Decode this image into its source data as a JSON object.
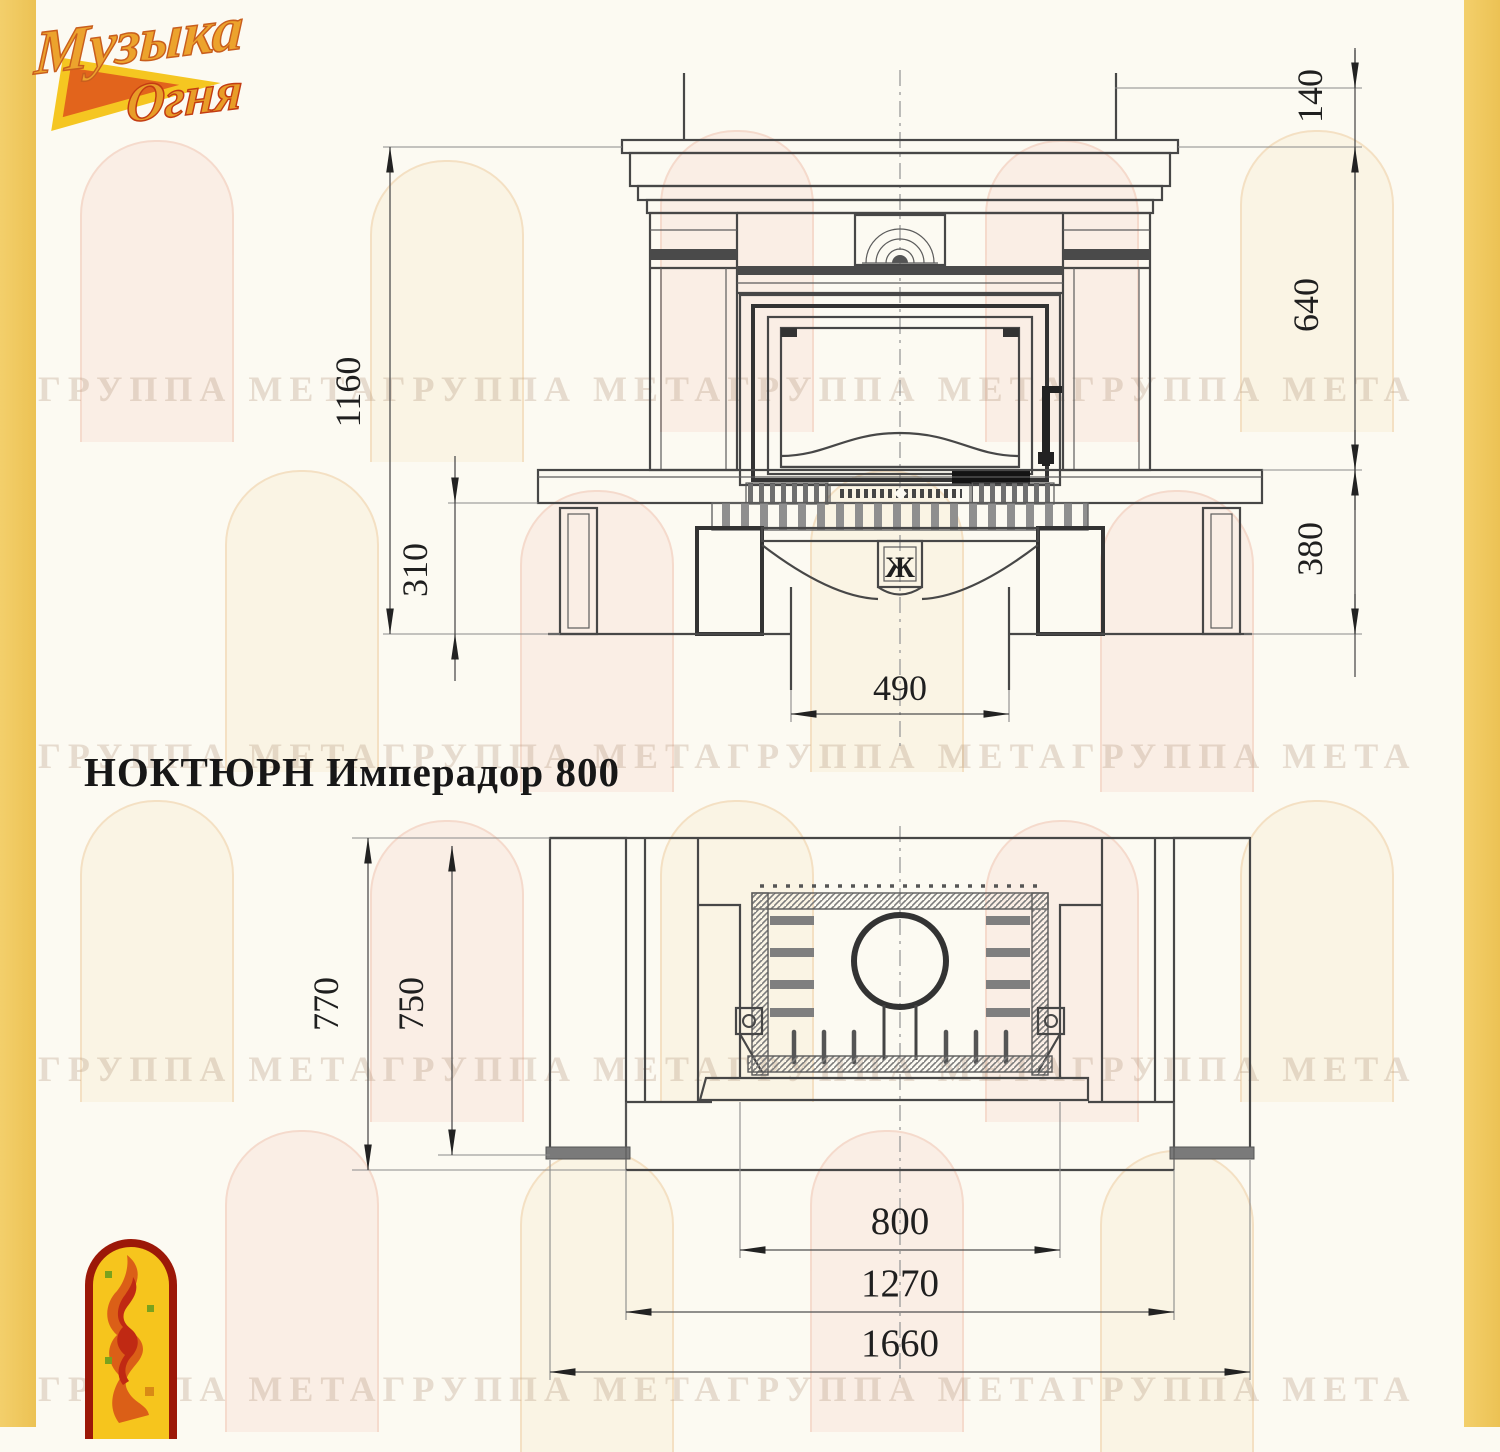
{
  "page": {
    "stripe_color": "#f0c85e",
    "line_color": "#474747",
    "background": "#fcfaf2"
  },
  "logo": {
    "line1": "Музыка",
    "line2": "Огня"
  },
  "title": "НОКТЮРН Имперадор 800",
  "watermark_text": "ГРУППА МЕТАГРУППА МЕТАГРУППА МЕТАГРУППА МЕТА",
  "front_view": {
    "dims": {
      "overall_height": "1160",
      "plinth_height": "310",
      "shelf_height": "140",
      "opening_height": "640",
      "base_height": "380",
      "column_width": "490"
    },
    "emblem_glyph": "Ж"
  },
  "plan_view": {
    "dims": {
      "overall_depth": "770",
      "inner_depth": "750",
      "firebox_width": "800",
      "body_width": "1270",
      "overall_width": "1660"
    }
  }
}
